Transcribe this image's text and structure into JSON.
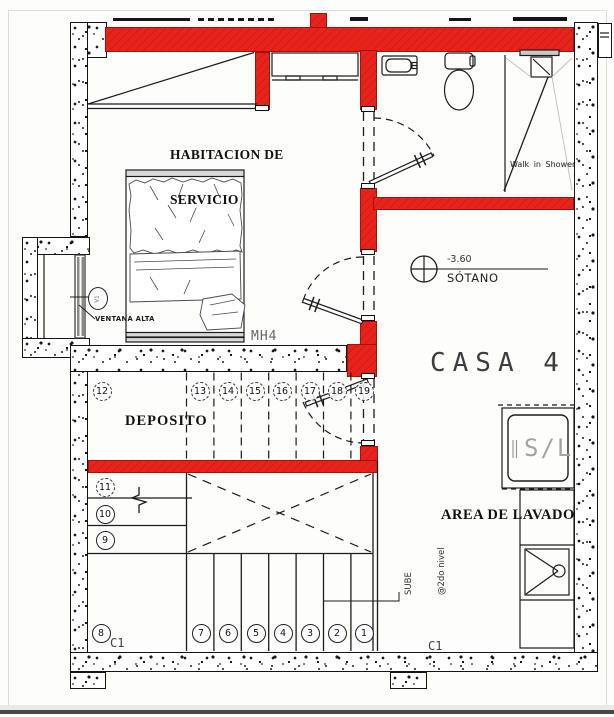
{
  "plan": {
    "house_label": "CASA 4",
    "rooms": {
      "habitacion_line1": "HABITACION DE",
      "habitacion_line2": "SERVICIO",
      "deposito": "DEPOSITO",
      "area_lavado": "AREA DE LAVADO"
    },
    "labels": {
      "ventana_alta": "VENTANA ALTA",
      "window_tag": "V1",
      "mh4": "MH4",
      "walk_in_shower": "Walk in Shower",
      "sube_line1": "SUBE",
      "sube_line2": "@2do nivel",
      "c1_left": "C1",
      "c1_right": "C1",
      "washer_dryer": "S/L"
    },
    "level_marker": {
      "elevation": "-3.60",
      "name": "SÓTANO"
    },
    "stairs": {
      "upper_flight": [
        "12",
        "13",
        "14",
        "15",
        "16",
        "17",
        "18",
        "19"
      ],
      "left_flight": [
        "11",
        "10",
        "9"
      ],
      "bottom_flight": [
        "8",
        "7",
        "6",
        "5",
        "4",
        "3",
        "2",
        "1"
      ]
    },
    "colors": {
      "wall_red": "#e8231c",
      "line_black": "#1b1b1b",
      "fixture_gray": "#9e9e9e",
      "concrete_dot": "#1a1a1a"
    }
  }
}
